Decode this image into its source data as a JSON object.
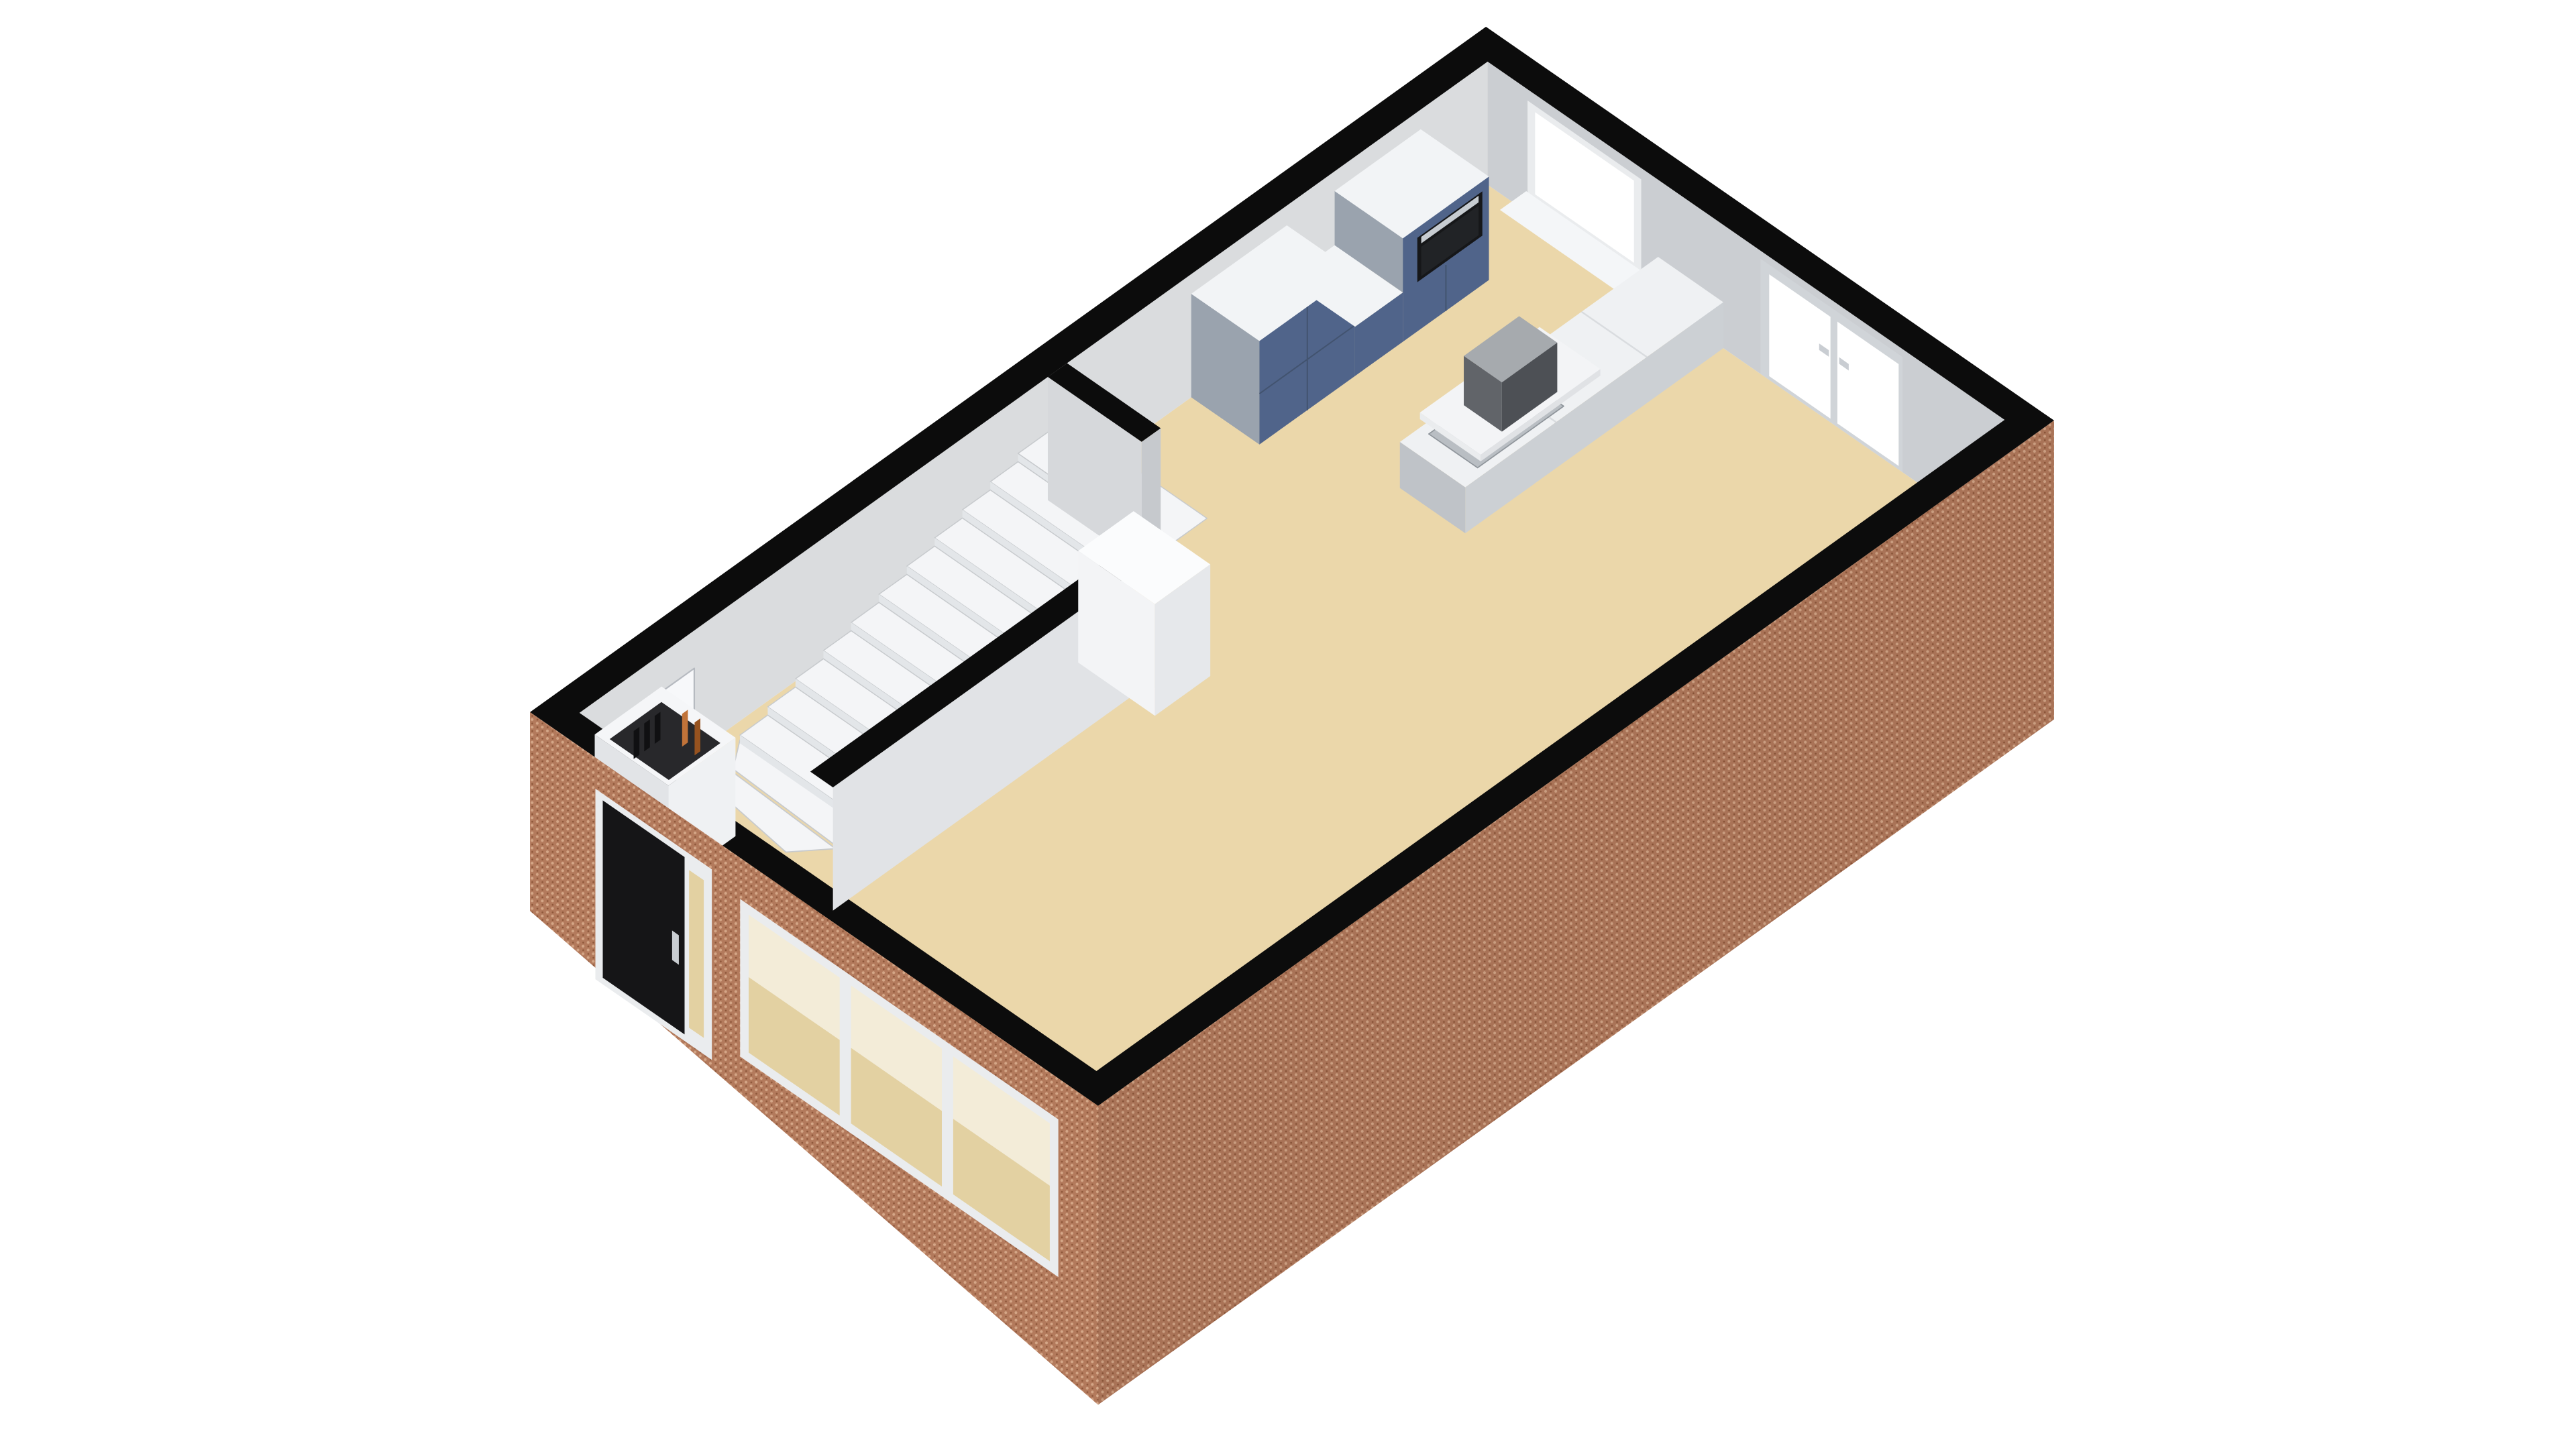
{
  "page": {
    "background": "#ffffff"
  },
  "scene": {
    "type": "3d-floorplan-render",
    "view": "axonometric-top",
    "storey": "ground-floor",
    "rooms": [
      "entry-hall",
      "staircase-hall",
      "living-room",
      "kitchen"
    ],
    "features": [
      "brick-facade-front",
      "brick-facade-side",
      "wall-top-band",
      "front-door",
      "front-door-handle",
      "front-door-sidelight",
      "front-window-band",
      "meter-cupboard",
      "meter-cupboard-contents",
      "vestibule-door",
      "winder-staircase",
      "stair-landing",
      "partition-stairs-living",
      "partition-hall-kitchen",
      "chimney-pillar",
      "kitchen-tall-cabinet-left",
      "kitchen-low-cabinet",
      "kitchen-tall-cabinet-right",
      "built-in-oven",
      "kitchen-window",
      "french-doors",
      "kitchen-island-counter",
      "gas-cooktop",
      "cooktop-burner",
      "splash-shelf",
      "extractor-hood",
      "floor"
    ]
  },
  "palette": {
    "background": "#ffffff",
    "band_black": "#0c0c0c",
    "floor": "#ebd7aa",
    "wall_nw": "#dadcde",
    "wall_ne": "#cbced2",
    "wall_p1": "#e1e3e6",
    "wall_p2": "#d6d8db",
    "wall_end": "#c6c9cd",
    "pillar_top": "#fbfcfd",
    "pillar_sw": "#f3f4f6",
    "pillar_se": "#e6e8eb",
    "stair_white": "#f4f5f7",
    "stair_riser": "#e3e6e9",
    "stair_edge": "#c7cacd",
    "door_white": "#f7f8fa",
    "door_outline": "#b6bac0",
    "cupboard_top": "#f5f6f8",
    "cupboard_face": "#eff1f3",
    "cupboard_side": "#e2e4e7",
    "cupboard_dark": "#28282b",
    "slab_dark": "#101012",
    "pipe_orange_1": "#c17339",
    "pipe_orange_2": "#96521f",
    "cabinet_blue": "#50648a",
    "cabinet_seam": "#42536f",
    "cabinet_top": "#f2f4f6",
    "cabinet_side": "#9aa3ae",
    "oven_black": "#161719",
    "oven_steel": "#c7ccd1",
    "oven_glass": "#212326",
    "counter_top": "#eff1f3",
    "counter_front": "#ccd0d4",
    "counter_side": "#bfc3c8",
    "counter_seam": "#d9dcdf",
    "cooktop_steel": "#b9bec3",
    "cooktop_edge": "#8f959b",
    "burner_dark": "#3a3d41",
    "burner_ring": "#9aa0a5",
    "slab_top": "#f3f4f6",
    "slab_front": "#e0e2e5",
    "slab_side": "#eaecee",
    "hood_top": "#a6aaae",
    "hood_sw": "#616469",
    "hood_se": "#4d5055",
    "brick_base": "#b37a5c",
    "brick_light": "#d4a687",
    "brick_dark": "#8e573a",
    "facade_se_shade": "rgba(0,0,0,0.05)",
    "frame_light": "#eaecee",
    "frame_gray": "#d0d4d8",
    "glass_white": "#ffffff",
    "glass_tint_hi": "#f3ecd8",
    "glass_tint_lo": "#e3d1a2",
    "door_black": "#151517",
    "handle_gray": "#c9cdd2",
    "window_sill": "#f4f6f8"
  }
}
